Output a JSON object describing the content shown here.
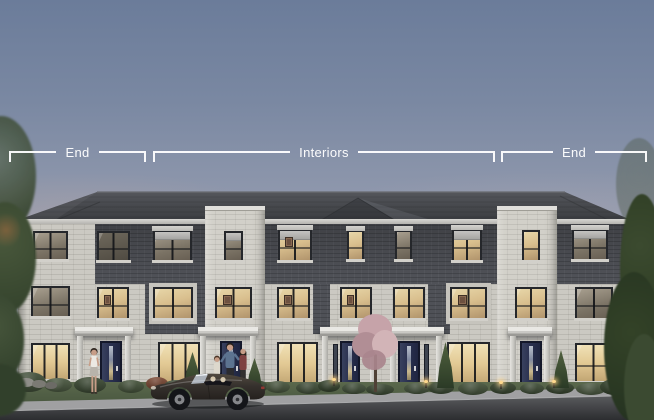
{
  "annotation": {
    "label_color": "#ffffff",
    "groups": [
      {
        "id": "left-end",
        "label": "End"
      },
      {
        "id": "interiors",
        "label": "Interiors"
      },
      {
        "id": "right-end",
        "label": "End"
      }
    ]
  },
  "palette": {
    "sky_top": "#6b7c9a",
    "sky_horizon": "#b2afba",
    "roof": "#45474b",
    "brick_dark": "#4f5157",
    "stone_light": "#cbc9c2",
    "tower_stone": "#d2d0c9",
    "window_frame": "#25272b",
    "window_lit": "#e0c898",
    "door_navy": "#2a3150",
    "label_color": "#ffffff",
    "foliage_dark": "#33422c",
    "grass": "#4e5a42",
    "sidewalk": "#9e9ea0",
    "road": "#3a3b3e",
    "car_body": "#37322e"
  }
}
